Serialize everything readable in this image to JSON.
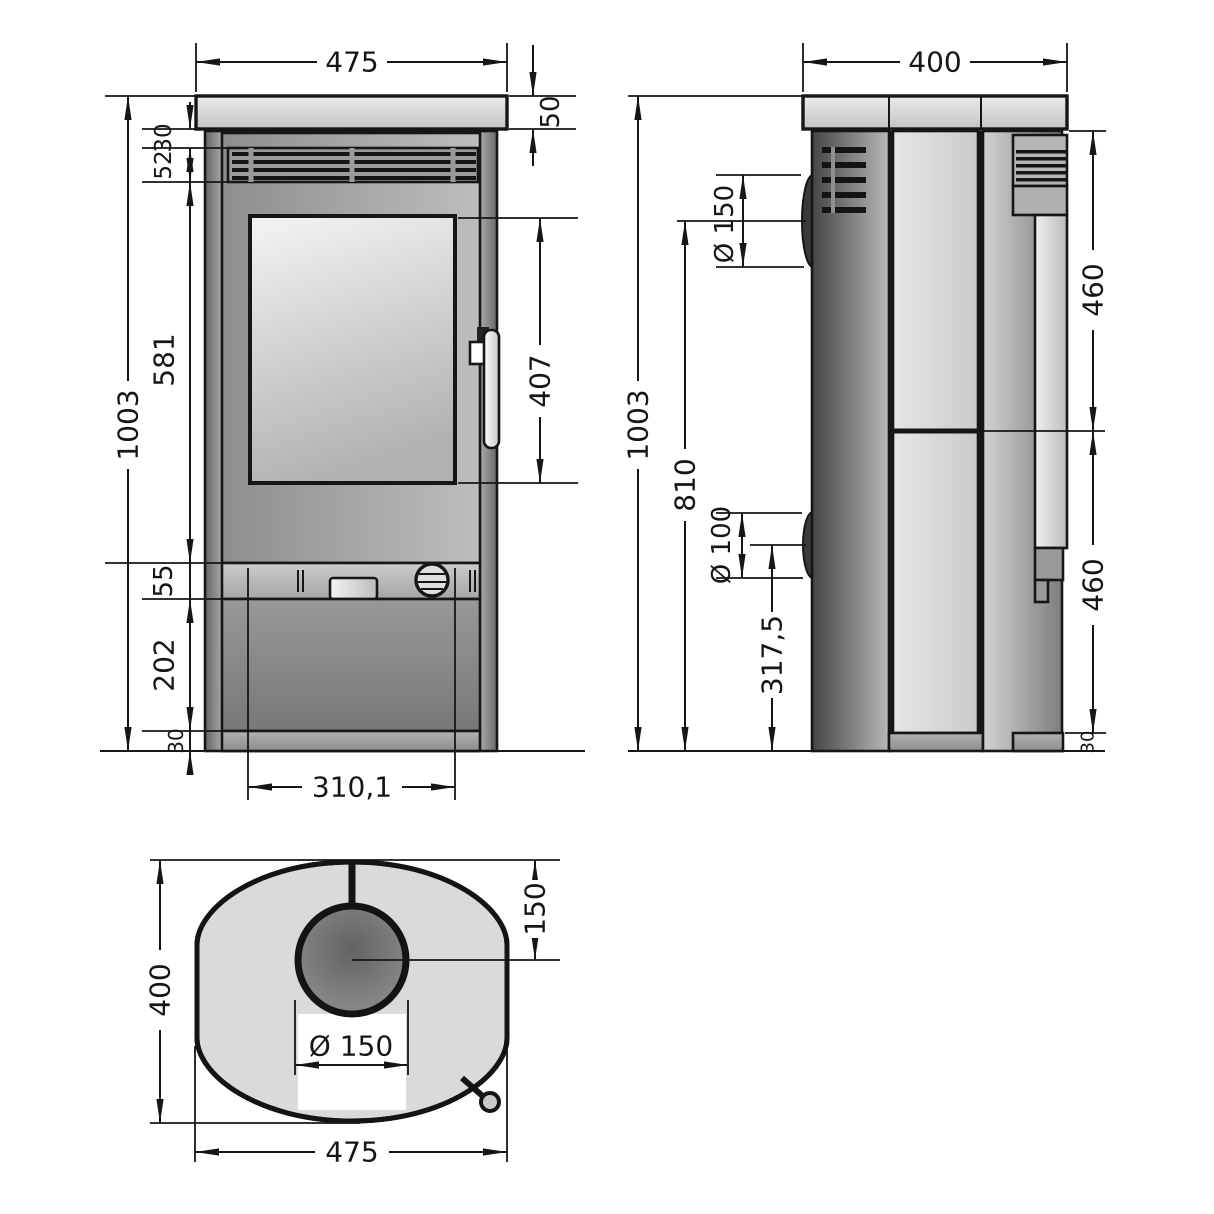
{
  "front": {
    "width": "475",
    "plate_height": "50",
    "gap_top": "30",
    "vent_height": "52",
    "door_section_height": "581",
    "band_height": "55",
    "pedestal_height": "202",
    "base_height": "30",
    "total_height": "1003",
    "glass_height": "407",
    "bottom_width": "310,1"
  },
  "side": {
    "depth": "400",
    "total_height": "1003",
    "flue_center_height": "810",
    "flue_diameter": "Ø 150",
    "outlet_diameter": "Ø 100",
    "outlet_center_height": "317,5",
    "cladding_upper": "460",
    "cladding_lower": "460",
    "base_height": "30"
  },
  "top": {
    "depth": "400",
    "flue_center_offset": "150",
    "flue_diameter": "Ø 150",
    "width": "475"
  }
}
